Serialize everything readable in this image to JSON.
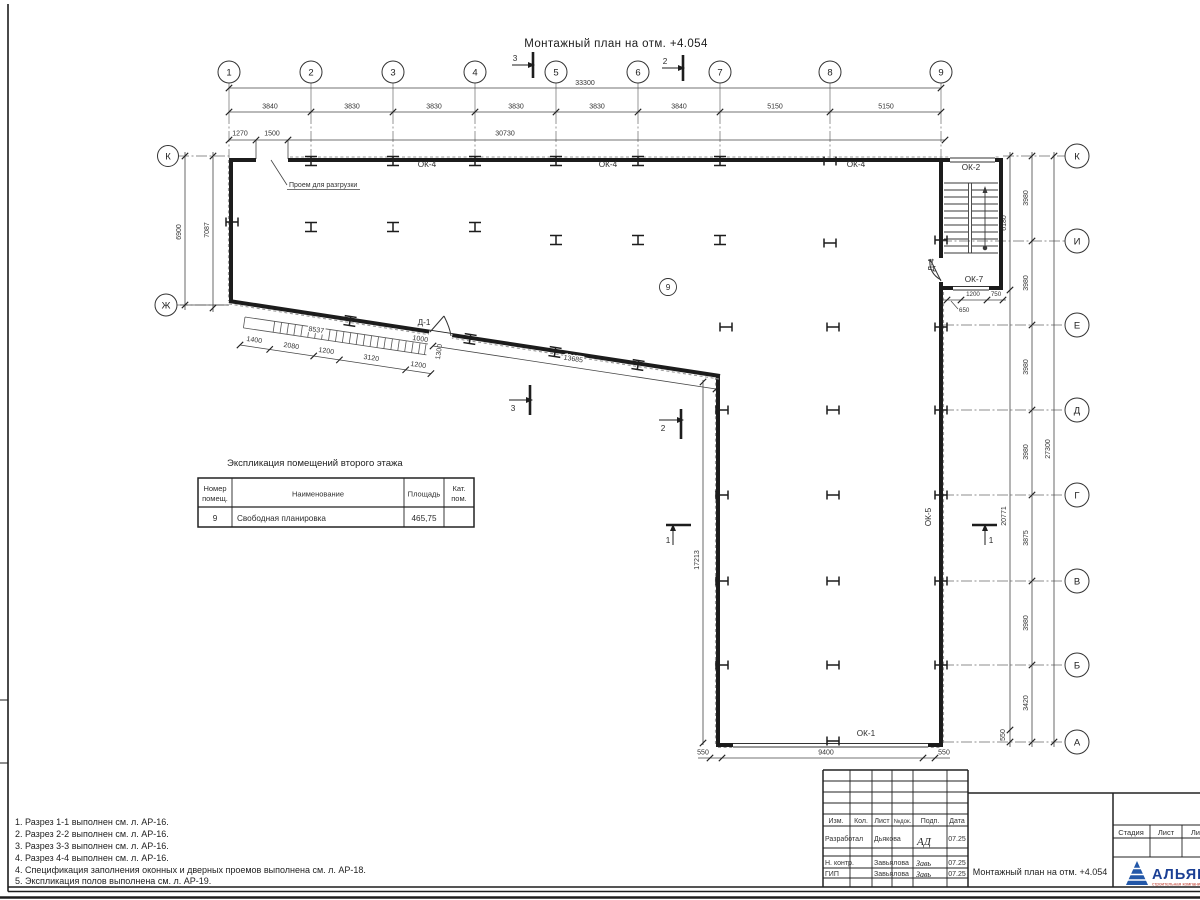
{
  "page_title": "Монтажный план на отм. +4.054",
  "grid": {
    "cols": [
      "1",
      "2",
      "3",
      "4",
      "5",
      "6",
      "7",
      "8",
      "9"
    ],
    "rows_right": [
      "К",
      "И",
      "Е",
      "Д",
      "Г",
      "В",
      "Б",
      "А"
    ],
    "rows_left": [
      "К",
      "Ж"
    ]
  },
  "dims": {
    "total_top": "33300",
    "seg_top": [
      "3840",
      "3830",
      "3830",
      "3830",
      "3830",
      "3840",
      "5150",
      "5150"
    ],
    "sub_top": [
      "1270",
      "1500",
      "30730"
    ],
    "left_a": "6900",
    "left_b": "7087",
    "stair_h": "6180",
    "right_wall": "20771",
    "right_wall_550": "550",
    "right_seg": [
      "3980",
      "3980",
      "3980",
      "3980",
      "3875",
      "3980",
      "3420"
    ],
    "right_total": "27300",
    "stair_b": [
      "1200",
      "750",
      "650"
    ],
    "band_total": "8537",
    "band_seg": [
      "1400",
      "2080",
      "1200",
      "3120",
      "1200"
    ],
    "band_end_a": "1000",
    "band_end_b": "1300",
    "diag": "13685",
    "lower_wall": "17213",
    "bottom": [
      "550",
      "9400",
      "550"
    ]
  },
  "marks": {
    "ok4": "ОК-4",
    "ok2": "ОК-2",
    "ok7": "ОК-7",
    "ok5": "ОК-5",
    "ok1": "ОК-1",
    "d1": "Д-1",
    "d4": "Д-4",
    "room": "9",
    "opening": "Проем для разгрузки",
    "s1": "1",
    "s2": "2",
    "s3": "3"
  },
  "table": {
    "title": "Экспликация помещений второго этажа",
    "col1_line1": "Номер",
    "col1_line2": "помещ.",
    "col2": "Наименование",
    "col3": "Площадь",
    "col4_line1": "Кат.",
    "col4_line2": "пом.",
    "row": {
      "num": "9",
      "name": "Свободная планировка",
      "area": "465,75"
    }
  },
  "notes": [
    "1. Разрез 1-1 выполнен см. л. АР-16.",
    "2. Разрез 2-2 выполнен см. л. АР-16.",
    "3. Разрез 3-3 выполнен см. л. АР-16.",
    "4. Разрез 4-4 выполнен см. л. АР-16.",
    "4. Спецификация заполнения оконных и дверных проемов выполнена см. л. АР-18.",
    "5. Экспликация полов выполнена см. л. АР-19."
  ],
  "titleblock": {
    "cols": [
      "Изм.",
      "Кол.",
      "Лист",
      "№док.",
      "Подп.",
      "Дата"
    ],
    "r1_role": "Разработал",
    "r1_name": "Дьякова",
    "r1_sig": "АД",
    "r1_date": "07.25",
    "r2_role": "Н. контр.",
    "r2_name": "Завьялова",
    "r2_sig": "Завь",
    "r2_date": "07.25",
    "r3_role": "ГИП",
    "r3_name": "Завьялова",
    "r3_sig": "Завь",
    "r3_date": "07.25",
    "doc": "Монтажный план на отм. +4.054",
    "stage": [
      "Стадия",
      "Лист",
      "Лист"
    ],
    "logo_name": "АЛЬЯНС",
    "logo_sub": "строительная компания"
  },
  "colors": {
    "line": "#2b2b2b",
    "dim": "#3a3a3a",
    "logo_blue": "#1b3f94",
    "logo_red": "#c03a2b"
  }
}
